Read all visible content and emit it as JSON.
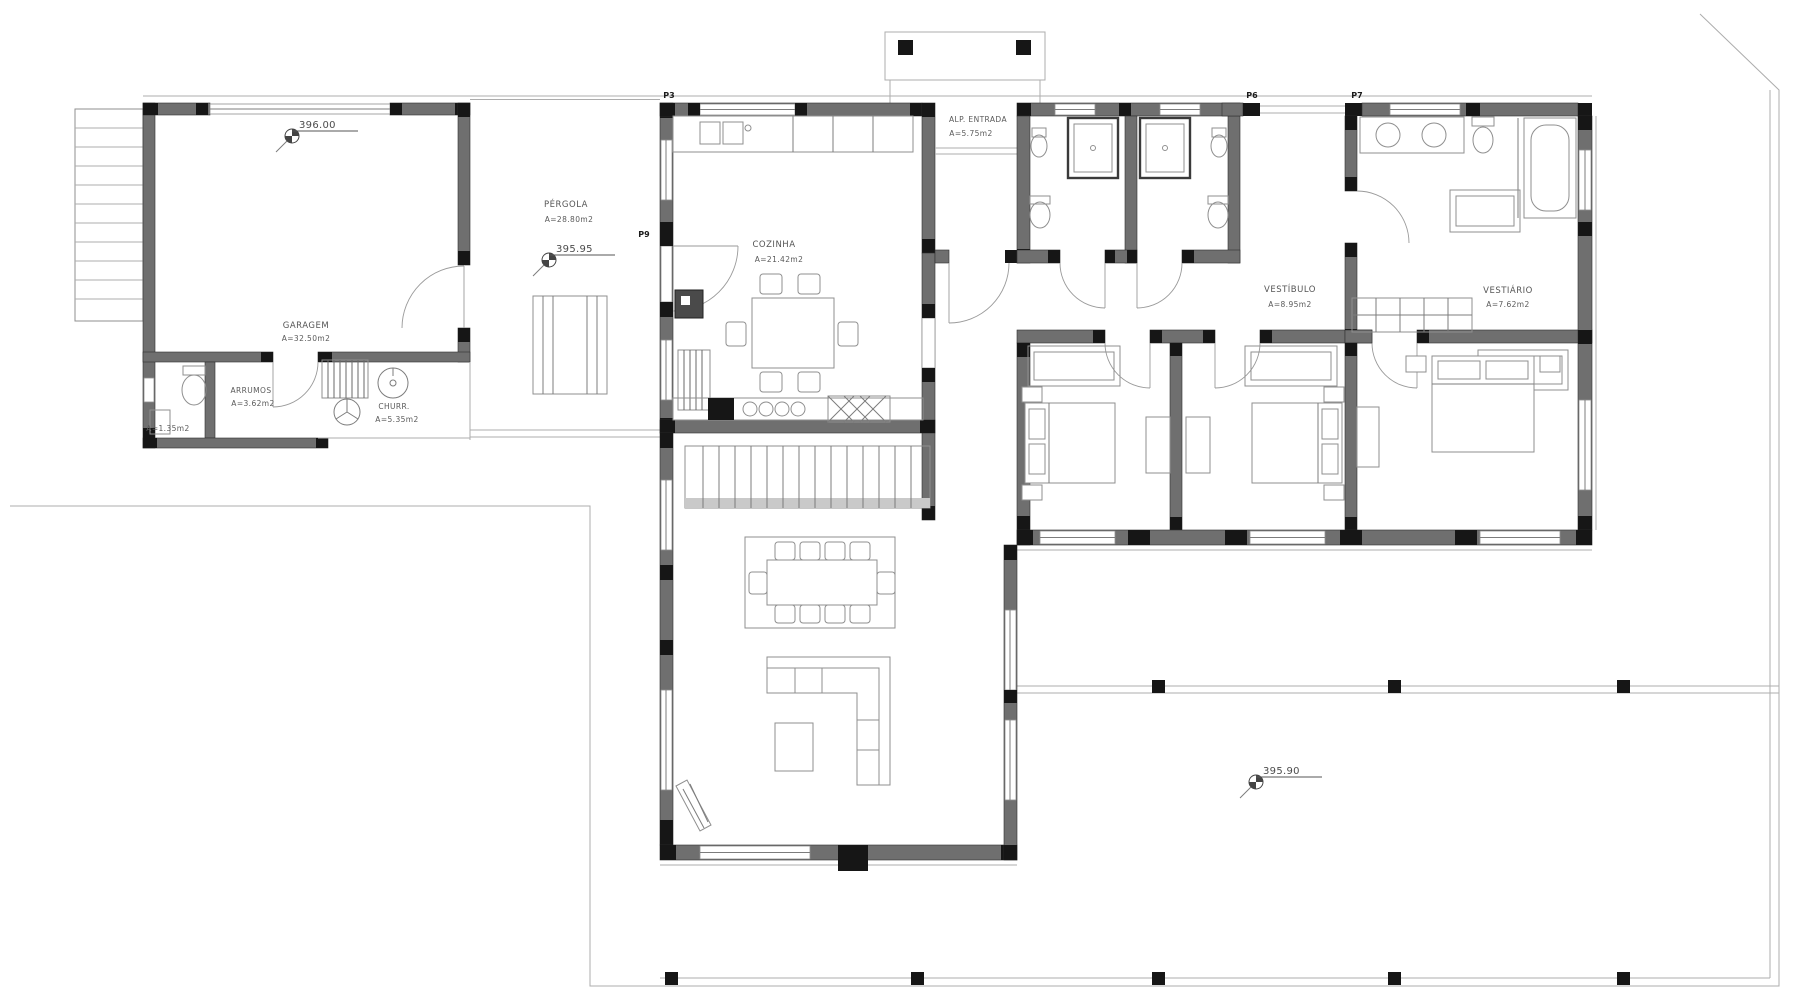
{
  "rooms": {
    "garagem": {
      "name": "GARAGEM",
      "area": "A=32.50m2"
    },
    "arrumos": {
      "name": "ARRUMOS",
      "area": "A=3.62m2"
    },
    "wc": {
      "area": "A=1.35m2"
    },
    "churrasqueira": {
      "name": "CHURR.",
      "area": "A=5.35m2"
    },
    "pergola": {
      "name": "PÉRGOLA",
      "area": "A=28.80m2"
    },
    "cozinha": {
      "name": "COZINHA",
      "area": "A=21.42m2"
    },
    "entrada": {
      "name": "ALP. ENTRADA",
      "area": "A=5.75m2"
    },
    "vestibulo": {
      "name": "VESTÍBULO",
      "area": "A=8.95m2"
    },
    "vestiario": {
      "name": "VESTIÁRIO",
      "area": "A=7.62m2"
    }
  },
  "elevations": {
    "garagem": "396.00",
    "pergola": "395.95",
    "terraco": "395.90"
  },
  "door_tags": {
    "p3": "P3",
    "p9": "P9",
    "p6": "P6",
    "p7": "P7"
  },
  "colors": {
    "wall": "#6f6f6f",
    "wall_dark": "#161616",
    "line": "#adadad",
    "text": "#555555",
    "background": "#ffffff"
  }
}
